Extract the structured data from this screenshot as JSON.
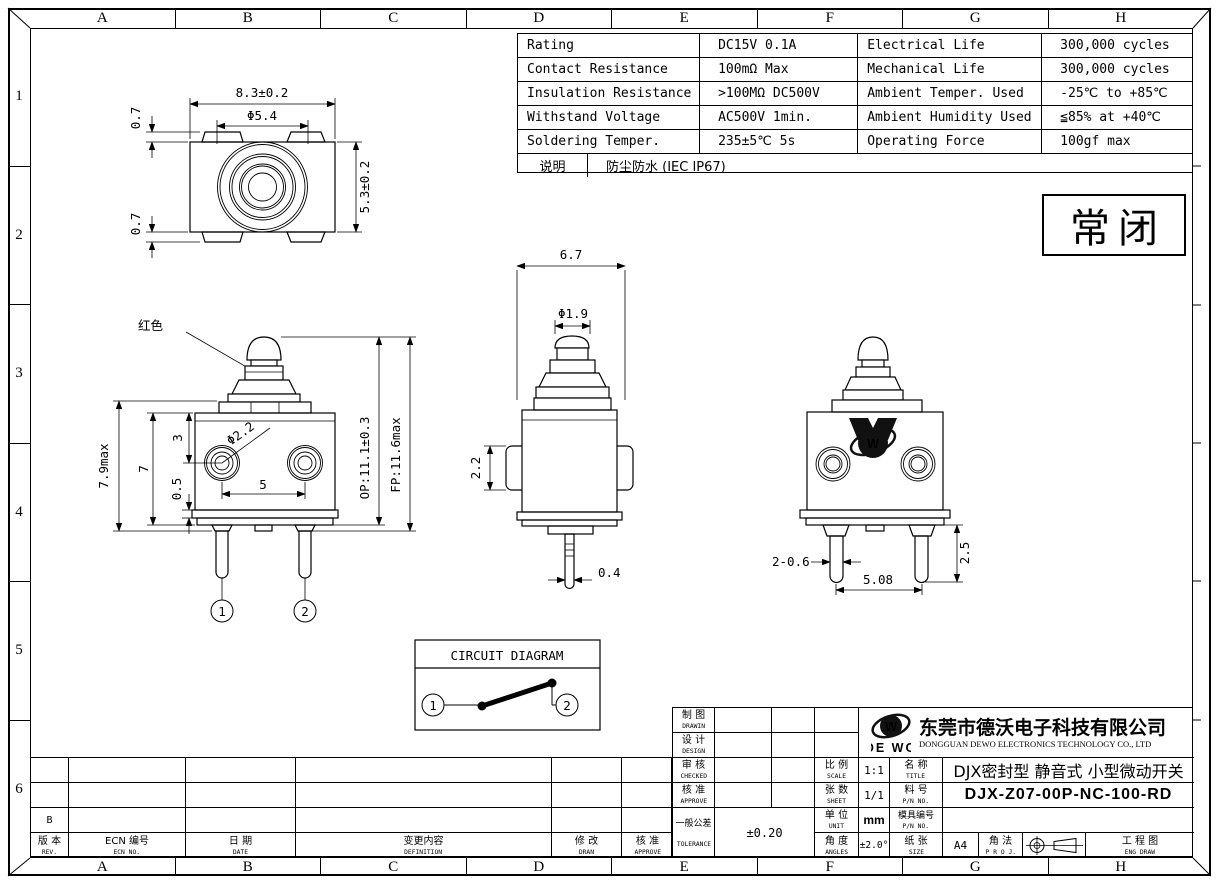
{
  "frame": {
    "letters": [
      "A",
      "B",
      "C",
      "D",
      "E",
      "F",
      "G",
      "H"
    ],
    "numbers": [
      "1",
      "2",
      "3",
      "4",
      "5",
      "6"
    ]
  },
  "spec_table": {
    "rows": [
      {
        "p": "Rating",
        "pv": "DC15V 0.1A",
        "q": "Electrical Life",
        "qv": "300,000 cycles"
      },
      {
        "p": "Contact Resistance",
        "pv": "100mΩ Max",
        "q": "Mechanical Life",
        "qv": "300,000 cycles"
      },
      {
        "p": "Insulation Resistance",
        "pv": ">100MΩ DC500V",
        "q": "Ambient Temper. Used",
        "qv": "-25℃ to +85℃"
      },
      {
        "p": "Withstand Voltage",
        "pv": "AC500V 1min.",
        "q": "Ambient Humidity Used",
        "qv": "≦85% at +40℃"
      },
      {
        "p": "Soldering Temper.",
        "pv": "235±5℃ 5s",
        "q": "Operating Force",
        "qv": "100gf max"
      }
    ],
    "note_label": "说明",
    "note_value": "防尘防水 (IEC IP67)"
  },
  "state_box": {
    "label": "常闭"
  },
  "views": {
    "top": {
      "dim_width": "8.3±0.2",
      "dim_button_dia": "Φ5.4",
      "dim_height": "5.3±0.2",
      "dim_tab_top": "0.7",
      "dim_tab_bottom": "0.7"
    },
    "front": {
      "color_note": "红色",
      "dim_height_max": "7.9max",
      "dim_body_height": "7",
      "dim_terminal_offset": "3",
      "dim_base_plate": "0.5",
      "dim_terminal_dia": "Φ2.2",
      "dim_pin_pitch": "5",
      "dim_op": "OP:11.1±0.3",
      "dim_fp": "FP:11.6max",
      "terminal_1": "1",
      "terminal_2": "2"
    },
    "side": {
      "dim_depth": "6.7",
      "dim_plunger_dia": "Φ1.9",
      "dim_tab_height": "2.2",
      "dim_pin_thickness": "0.4"
    },
    "back": {
      "dim_pin_width": "2-0.6",
      "dim_pin_pitch": "5.08",
      "dim_pin_length": "2.5"
    }
  },
  "circuit": {
    "title": "CIRCUIT DIAGRAM",
    "t1": "1",
    "t2": "2"
  },
  "title_block": {
    "company": {
      "logo_w": "W",
      "logo_text": "DE WO",
      "name_cn": "东莞市德沃电子科技有限公司",
      "name_en": "DONGGUAN DEWO ELECTRONICS TECHNOLOGY CO., LTD"
    },
    "drawn": {
      "cn": "制 图",
      "en": "DRAWIN"
    },
    "design": {
      "cn": "设 计",
      "en": "DESIGN"
    },
    "checked": {
      "cn": "审 核",
      "en": "CHECKED"
    },
    "approve": {
      "cn": "核 准",
      "en": "APPROVE"
    },
    "tolerance": {
      "cn": "一般公差",
      "en": "TOLERANCE",
      "value": "±0.20"
    },
    "scale": {
      "cn": "比 例",
      "en": "SCALE",
      "value": "1:1"
    },
    "sheet": {
      "cn": "张 数",
      "en": "SHEET",
      "value": "1/1"
    },
    "unit": {
      "cn": "单 位",
      "en": "UNIT",
      "value": "mm"
    },
    "angles": {
      "cn": "角 度",
      "en": "ANGLES",
      "value": "±2.0°"
    },
    "title": {
      "cn": "名 称",
      "en": "TITLE",
      "value": "DJX密封型 静音式 小型微动开关"
    },
    "pn": {
      "cn": "料 号",
      "en": "P/N NO.",
      "value": "DJX-Z07-00P-NC-100-RD"
    },
    "mold": {
      "cn": "模具编号",
      "en": "P/N NO.",
      "value": ""
    },
    "size": {
      "cn": "纸 张",
      "en": "SIZE",
      "value": "A4"
    },
    "proj": {
      "cn": "角 法",
      "en": "P R O J."
    },
    "eng": {
      "cn": "工 程 图",
      "en": "ENG DRAW"
    }
  },
  "revision_table": {
    "headers": [
      {
        "cn": "版 本",
        "en": "REV."
      },
      {
        "cn": "ECN 编号",
        "en": "ECN NO."
      },
      {
        "cn": "日 期",
        "en": "DATE"
      },
      {
        "cn": "变更内容",
        "en": "DEFINITION"
      },
      {
        "cn": "修 改",
        "en": "DRAN"
      },
      {
        "cn": "核 准",
        "en": "APPROVE"
      }
    ],
    "rev_b": "B"
  }
}
